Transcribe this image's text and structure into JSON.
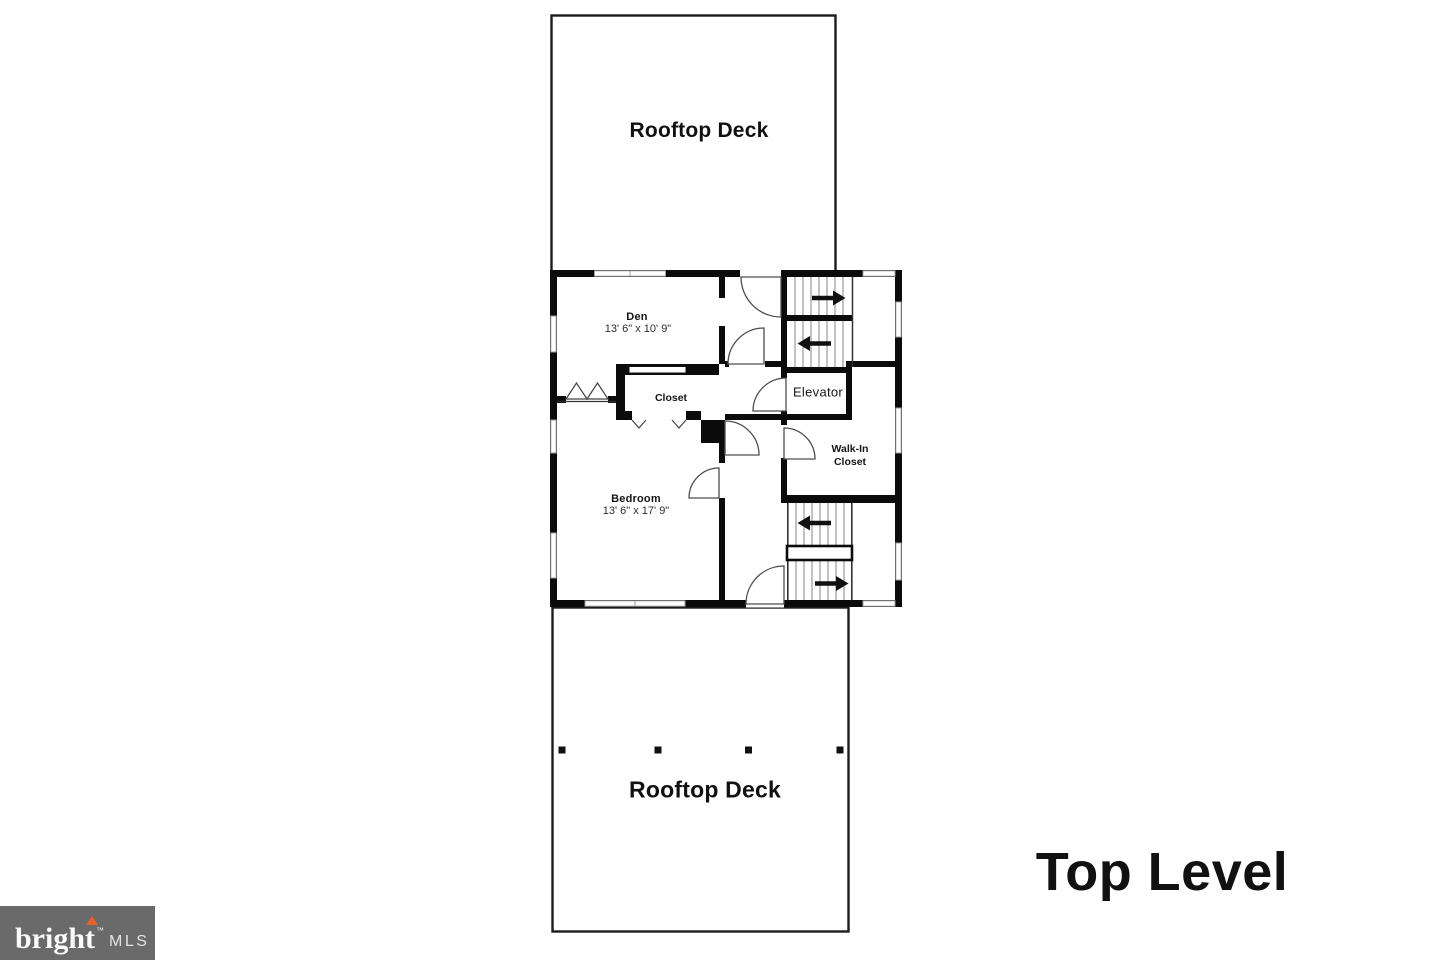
{
  "page": {
    "background": "#ffffff"
  },
  "decks": {
    "top": {
      "label": "Rooftop Deck"
    },
    "bottom": {
      "label": "Rooftop Deck"
    }
  },
  "rooms": {
    "den": {
      "name": "Den",
      "dims": "13' 6\" x 10' 9\""
    },
    "closet": {
      "name": "Closet"
    },
    "elevator": {
      "name": "Elevator"
    },
    "walk_in": {
      "line1": "Walk-In",
      "line2": "Closet"
    },
    "bedroom": {
      "name": "Bedroom",
      "dims": "13' 6\" x 17' 9\""
    }
  },
  "stairs": {
    "upper": {
      "up_arrow": "right",
      "down_arrow": "left"
    },
    "lower": {
      "up_arrow": "left",
      "down_arrow": "right"
    }
  },
  "level": {
    "label": "Top Level"
  },
  "logo": {
    "brand": "bright",
    "trademark": "™",
    "suffix": "MLS",
    "accent": "#e4632d",
    "background": "#6a6a6a"
  },
  "colors": {
    "wall": "#0b0b0b",
    "window_frame": "#9d9d9d",
    "door_arc": "#4d4d4d"
  }
}
